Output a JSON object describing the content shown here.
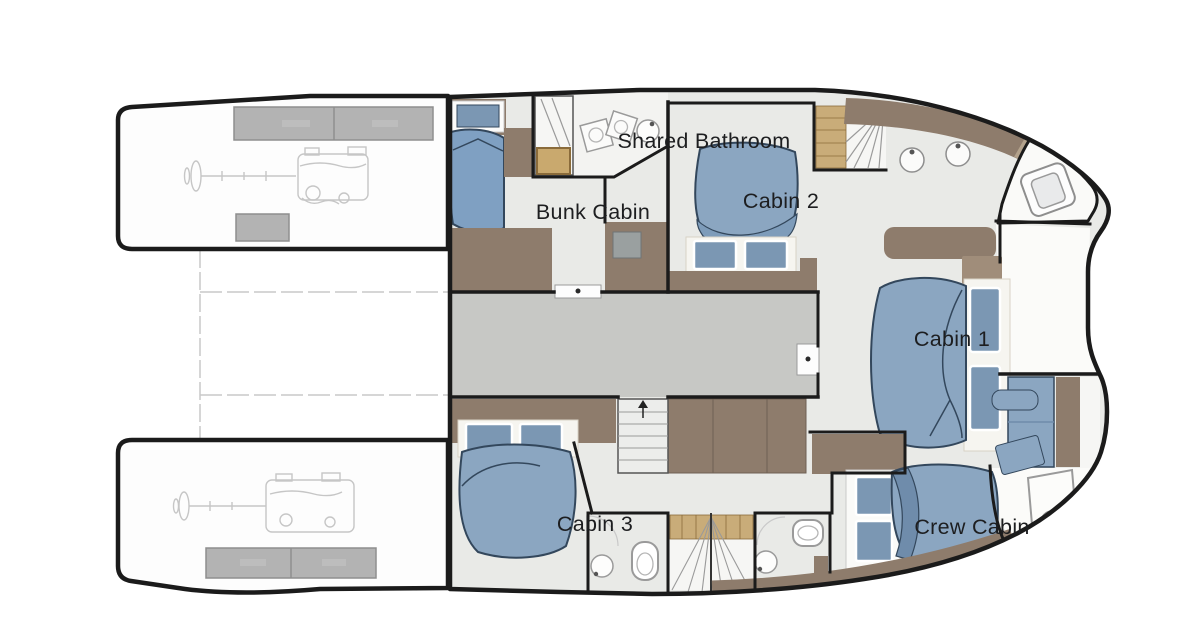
{
  "page": {
    "type": "yacht-floor-plan",
    "canvas_width": 1200,
    "canvas_height": 644,
    "background": "#ffffff"
  },
  "rooms": [
    {
      "id": "shared-bathroom",
      "label": "Shared Bathroom",
      "fixtures": [
        "shower",
        "sink",
        "sink",
        "vanity"
      ]
    },
    {
      "id": "bunk-cabin",
      "label": "Bunk Cabin",
      "fixtures": [
        "bunk-bed",
        "window",
        "cabinet",
        "sink-unit"
      ]
    },
    {
      "id": "cabin-2",
      "label": "Cabin 2",
      "fixtures": [
        "double-bed",
        "pillow",
        "pillow",
        "dresser"
      ]
    },
    {
      "id": "cabin-1",
      "label": "Cabin 1",
      "fixtures": [
        "double-bed",
        "pillow",
        "pillow",
        "sofa",
        "shelf"
      ]
    },
    {
      "id": "cabin-3",
      "label": "Cabin 3",
      "fixtures": [
        "double-bed",
        "pillow",
        "pillow",
        "ensuite-toilet",
        "ensuite-sink"
      ]
    },
    {
      "id": "crew-cabin",
      "label": "Crew Cabin",
      "fixtures": [
        "berth",
        "pillow",
        "pillow",
        "desk",
        "chair",
        "hatch"
      ]
    }
  ],
  "areas": {
    "engine_room_port": {
      "tanks": 3,
      "features": [
        "engine-sketch",
        "prop-shaft-sketch"
      ]
    },
    "engine_room_starboard": {
      "tanks": 2,
      "features": [
        "engine-sketch",
        "prop-shaft-sketch"
      ]
    },
    "galley_passage": {
      "features": [
        "sink",
        "sink",
        "counter"
      ]
    },
    "staircases": 3,
    "bathrooms_aft": 2,
    "bow_toilet_room": {
      "features": [
        "toilet"
      ]
    }
  },
  "colors": {
    "hull_outline": "#1b1b1b",
    "floor": "#e9eae7",
    "corridor_floor": "#c7c8c5",
    "bathroom_floor": "#f3f3f1",
    "furniture_taupe": "#8e7c6c",
    "furniture_taupe_light": "#a79482",
    "wood_steps": "#c9ac79",
    "bed_duvet": "#8ba6c1",
    "bed_duvet_dark": "#7e9cba",
    "pillow_blue": "#7b97b3",
    "bed_outline": "#33475c",
    "tank_gray": "#b3b3b3",
    "faint_line": "#c9c9c9",
    "label_text": "#1d1e20"
  }
}
